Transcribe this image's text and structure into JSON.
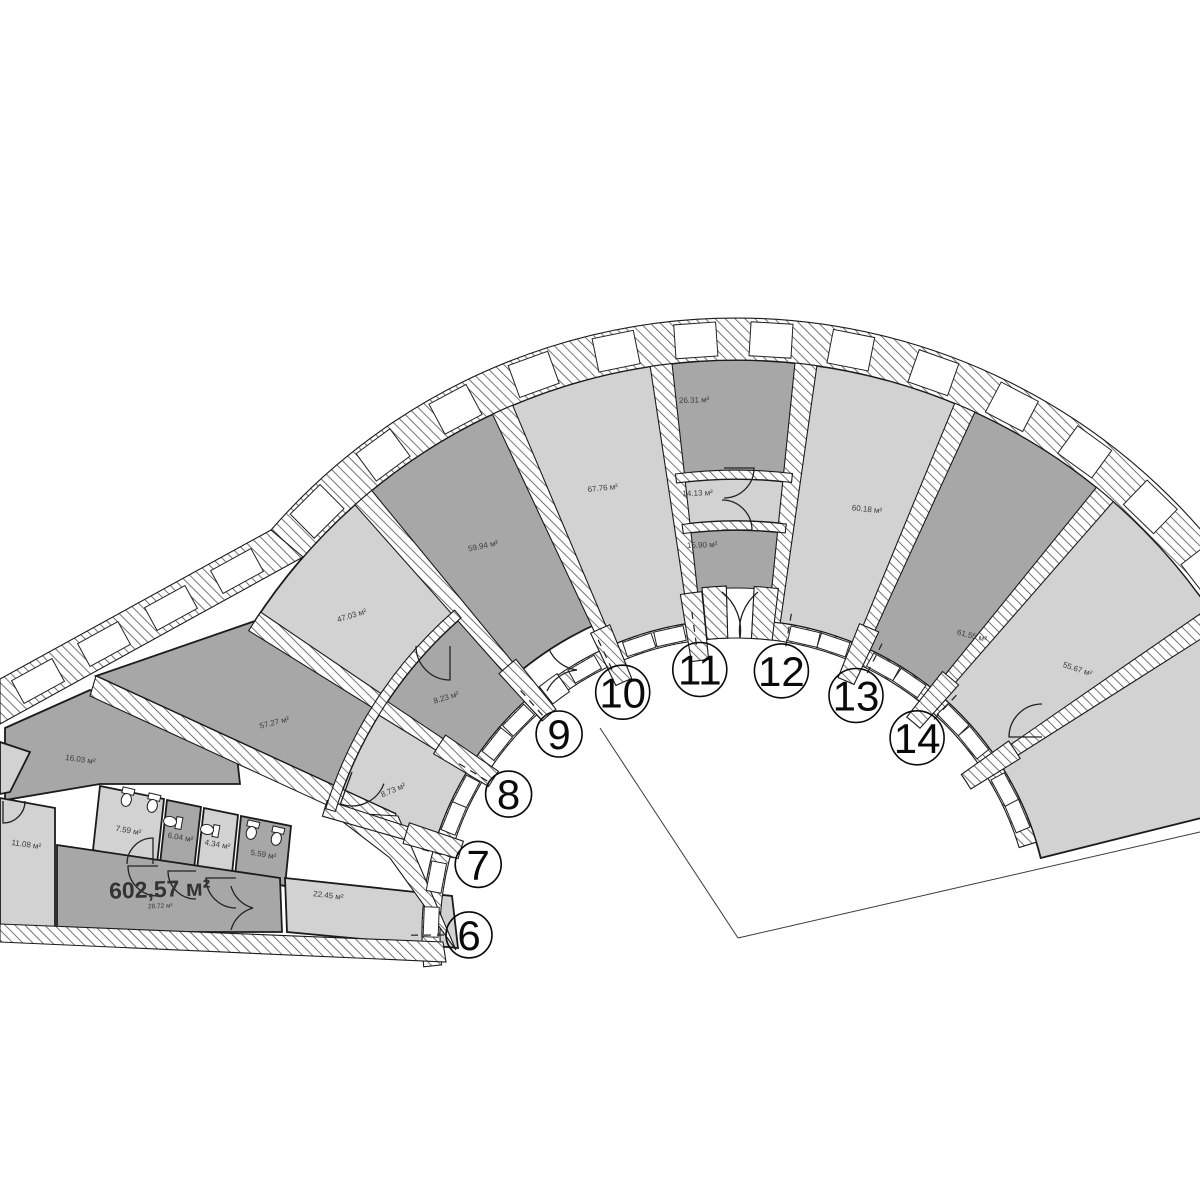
{
  "colors": {
    "background": "#ffffff",
    "room_light": "#d2d2d2",
    "room_dark": "#a7a7a7",
    "wall_line": "#1b1b1b",
    "hatch_line": "#444444",
    "label_text": "#3c3c3c",
    "number_text": "#0a0a0a"
  },
  "plan": {
    "center": [
      736,
      934
    ],
    "units": [
      {
        "number": "6",
        "angle": 180.2,
        "size": "small"
      },
      {
        "number": "7",
        "angle": 164.9,
        "size": "small"
      },
      {
        "number": "8",
        "angle": 148.4,
        "size": "small"
      },
      {
        "number": "9",
        "angle": 131.5,
        "size": "small"
      },
      {
        "number": "10",
        "angle": 115.1,
        "size": "large"
      },
      {
        "number": "11",
        "angle": 97.8,
        "size": "large"
      },
      {
        "number": "12",
        "angle": 80.2,
        "size": "large"
      },
      {
        "number": "13",
        "angle": 63.3,
        "size": "large"
      },
      {
        "number": "14",
        "angle": 47.3,
        "size": "large"
      }
    ],
    "wedge_rooms": [
      {
        "name": "room-edge-sliver",
        "area": "",
        "fill": "light",
        "a1": 14,
        "a2": 33.5,
        "r1": 314,
        "r2": 574,
        "label": null
      },
      {
        "name": "room-55-67",
        "area": "55.67 м²",
        "fill": "light",
        "a1": 33.5,
        "a2": 50,
        "r1": 314,
        "r2": 574,
        "label": {
          "a": 37.6,
          "r": 430,
          "rot": 18
        }
      },
      {
        "name": "room-14",
        "area": "61.55 м²",
        "fill": "dark",
        "a1": 50,
        "a2": 66.5,
        "r1": 314,
        "r2": 574,
        "label": {
          "a": 51.5,
          "r": 378,
          "rot": 14
        }
      },
      {
        "name": "room-13",
        "area": "60.18 м²",
        "fill": "light",
        "a1": 66.5,
        "a2": 83,
        "r1": 314,
        "r2": 574,
        "label": {
          "a": 72.8,
          "r": 442,
          "rot": 6
        }
      },
      {
        "name": "room-12-top",
        "area": "26.31 м²",
        "fill": "dark",
        "a1": 83,
        "a2": 97.5,
        "r1": 460,
        "r2": 574,
        "label": {
          "a": 94.5,
          "r": 533,
          "rot": -2
        }
      },
      {
        "name": "room-12-mid",
        "area": "14.13 м²",
        "fill": "light",
        "a1": 83,
        "a2": 97.5,
        "r1": 413,
        "r2": 455,
        "label": {
          "a": 95.0,
          "r": 440,
          "rot": -2
        }
      },
      {
        "name": "room-11-low",
        "area": "15.90 м²",
        "fill": "dark",
        "a1": 83,
        "a2": 97.5,
        "r1": 330,
        "r2": 404,
        "label": {
          "a": 95.0,
          "r": 388,
          "rot": -2
        }
      },
      {
        "name": "room-10",
        "area": "67.76 м²",
        "fill": "light",
        "a1": 97.5,
        "a2": 114,
        "r1": 314,
        "r2": 574,
        "label": {
          "a": 106.7,
          "r": 463,
          "rot": -6
        }
      },
      {
        "name": "room-9",
        "area": "59.94 м²",
        "fill": "dark",
        "a1": 114,
        "a2": 130.5,
        "r1": 340,
        "r2": 574,
        "label": {
          "a": 123.2,
          "r": 461,
          "rot": -12
        }
      },
      {
        "name": "room-8",
        "area": "47.03 м²",
        "fill": "light",
        "a1": 130.5,
        "a2": 147,
        "r1": 425,
        "r2": 574,
        "label": {
          "a": 140.5,
          "r": 497,
          "rot": -17
        }
      },
      {
        "name": "room-8-23",
        "area": "8.23 м²",
        "fill": "dark",
        "a1": 131,
        "a2": 147.4,
        "r1": 314,
        "r2": 419,
        "label": {
          "a": 141.0,
          "r": 372,
          "rot": -17
        }
      },
      {
        "name": "room-8-73",
        "area": "8.73 м²",
        "fill": "light",
        "a1": 147.4,
        "a2": 163,
        "r1": 314,
        "r2": 419,
        "label": {
          "a": 157.5,
          "r": 370,
          "rot": -23
        }
      }
    ],
    "poly_rooms": [
      {
        "name": "room-7",
        "area": "57.27 м²",
        "fill": "dark",
        "points": [
          [
            380,
            703
          ],
          [
            255,
            621
          ],
          [
            96,
            676
          ],
          [
            396,
            814
          ],
          [
            330,
            812
          ]
        ],
        "label": {
          "x": 275,
          "y": 725,
          "rot": -14
        }
      },
      {
        "name": "room-16-03",
        "area": "16.03 м²",
        "fill": "dark",
        "points": [
          [
            5,
            728
          ],
          [
            90,
            690
          ],
          [
            237,
            757
          ],
          [
            240,
            784
          ],
          [
            100,
            784
          ],
          [
            5,
            800
          ]
        ],
        "label": {
          "x": 80,
          "y": 762,
          "rot": 8
        }
      },
      {
        "name": "room-7-59",
        "area": "7.59 м²",
        "fill": "light",
        "points": [
          [
            100,
            786
          ],
          [
            164,
            799
          ],
          [
            157,
            864
          ],
          [
            93,
            850
          ]
        ],
        "label": {
          "x": 128,
          "y": 833,
          "rot": 10
        }
      },
      {
        "name": "room-6-04",
        "area": "6.04 м²",
        "fill": "dark",
        "points": [
          [
            167,
            800
          ],
          [
            201,
            807
          ],
          [
            194,
            869
          ],
          [
            160,
            864
          ]
        ],
        "label": {
          "x": 180,
          "y": 840,
          "rot": 10
        }
      },
      {
        "name": "room-4-34",
        "area": "4.34 м²",
        "fill": "light",
        "points": [
          [
            204,
            808
          ],
          [
            238,
            815
          ],
          [
            232,
            874
          ],
          [
            197,
            869
          ]
        ],
        "label": {
          "x": 217,
          "y": 847,
          "rot": 10
        }
      },
      {
        "name": "room-5-59",
        "area": "5.59 м²",
        "fill": "dark",
        "points": [
          [
            241,
            816
          ],
          [
            291,
            826
          ],
          [
            285,
            886
          ],
          [
            235,
            876
          ]
        ],
        "label": {
          "x": 263,
          "y": 857,
          "rot": 10
        }
      },
      {
        "name": "room-11-08",
        "area": "11.08 м²",
        "fill": "light",
        "points": [
          [
            0,
            798
          ],
          [
            55,
            808
          ],
          [
            55,
            932
          ],
          [
            0,
            932
          ]
        ],
        "label": {
          "x": 26,
          "y": 847,
          "rot": 8
        }
      },
      {
        "name": "room-602",
        "area": "",
        "fill": "dark",
        "points": [
          [
            57,
            845
          ],
          [
            280,
            878
          ],
          [
            282,
            932
          ],
          [
            57,
            932
          ]
        ],
        "label": null
      },
      {
        "name": "room-22-45",
        "area": "22.45 м²",
        "fill": "light",
        "points": [
          [
            285,
            878
          ],
          [
            452,
            896
          ],
          [
            458,
            948
          ],
          [
            287,
            932
          ]
        ],
        "label": {
          "x": 328,
          "y": 898,
          "rot": 7
        }
      },
      {
        "name": "room-left-sliver",
        "area": "",
        "fill": "light",
        "points": [
          [
            0,
            742
          ],
          [
            30,
            752
          ],
          [
            10,
            792
          ],
          [
            0,
            794
          ]
        ],
        "label": null
      }
    ],
    "main_area_label": {
      "text": "602,57 м²",
      "sub": "28.72 м²",
      "x": 160,
      "y": 897,
      "rot": -2
    },
    "walls": {
      "outer_arc": {
        "a1": 14,
        "a2": 139,
        "r1": 574,
        "r2": 616
      },
      "inner_arc": {
        "a1": 17,
        "a2": 186,
        "r1": 296,
        "r2": 314
      },
      "outer_straight": [
        [
          271,
          530
        ],
        [
          0,
          679
        ],
        [
          0,
          724
        ],
        [
          303,
          557
        ]
      ],
      "band_diag": [
        [
          96,
          676
        ],
        [
          396,
          814
        ],
        [
          390,
          834
        ],
        [
          90,
          696
        ]
      ],
      "filler_right": [
        [
          330,
          812
        ],
        [
          398,
          816
        ],
        [
          456,
          950
        ],
        [
          390,
          858
        ]
      ],
      "bottom_band": [
        [
          0,
          924
        ],
        [
          443,
          942
        ],
        [
          446,
          962
        ],
        [
          0,
          942
        ]
      ],
      "radial": [
        {
          "a": 33.5,
          "r1": 314,
          "r2": 574
        },
        {
          "a": 50,
          "r1": 314,
          "r2": 574
        },
        {
          "a": 66.5,
          "r1": 314,
          "r2": 574
        },
        {
          "a": 83,
          "r1": 314,
          "r2": 574
        },
        {
          "a": 97.5,
          "r1": 314,
          "r2": 574
        },
        {
          "a": 114,
          "r1": 314,
          "r2": 574
        },
        {
          "a": 130.5,
          "r1": 314,
          "r2": 574
        },
        {
          "a": 147,
          "r1": 425,
          "r2": 574
        },
        {
          "a": 147.4,
          "r1": 300,
          "r2": 425
        },
        {
          "a": 163,
          "r1": 296,
          "r2": 430
        }
      ],
      "stubs": [
        {
          "a": 33.5,
          "r1": 276,
          "r2": 334
        },
        {
          "a": 50,
          "r1": 276,
          "r2": 334
        },
        {
          "a": 66.5,
          "r1": 276,
          "r2": 334
        },
        {
          "a": 97.5,
          "r1": 276,
          "r2": 344
        },
        {
          "a": 114,
          "r1": 276,
          "r2": 334
        },
        {
          "a": 130.5,
          "r1": 288,
          "r2": 352
        },
        {
          "a": 147.4,
          "r1": 288,
          "r2": 352
        },
        {
          "a": 163,
          "r1": 288,
          "r2": 345
        }
      ],
      "column_arcs": [
        {
          "a1": 83,
          "a2": 97.5,
          "r1": 455,
          "r2": 464
        },
        {
          "a1": 83,
          "a2": 97.5,
          "r1": 404,
          "r2": 413
        }
      ],
      "small_room_arc": {
        "a1": 131,
        "a2": 163,
        "r1": 419,
        "r2": 429
      },
      "entrance_piers": [
        {
          "a1": 83,
          "a2": 87,
          "r1": 296,
          "r2": 348
        },
        {
          "a1": 91.6,
          "a2": 95.6,
          "r1": 296,
          "r2": 348
        }
      ]
    },
    "openings": {
      "outer_window_segments": [
        {
          "a1": 14,
          "a2": 33.5,
          "n": 3
        },
        {
          "a1": 33.5,
          "a2": 50,
          "n": 2
        },
        {
          "a1": 50,
          "a2": 66.5,
          "n": 2
        },
        {
          "a1": 66.5,
          "a2": 83,
          "n": 2
        },
        {
          "a1": 83,
          "a2": 97.5,
          "n": 2
        },
        {
          "a1": 97.5,
          "a2": 114,
          "n": 2
        },
        {
          "a1": 114,
          "a2": 130.5,
          "n": 2
        },
        {
          "a1": 130.5,
          "a2": 139,
          "n": 1
        }
      ],
      "inner_window_segments": [
        {
          "a1": 20,
          "a2": 31,
          "n": 2
        },
        {
          "a1": 36,
          "a2": 47.5,
          "n": 2
        },
        {
          "a1": 52.5,
          "a2": 64,
          "n": 2
        },
        {
          "a1": 68.5,
          "a2": 80,
          "n": 2
        },
        {
          "a1": 99.5,
          "a2": 111.5,
          "n": 2
        },
        {
          "a1": 116.5,
          "a2": 123,
          "n": 1
        },
        {
          "a1": 132.5,
          "a2": 144.5,
          "n": 2
        },
        {
          "a1": 149.5,
          "a2": 160.5,
          "n": 2
        },
        {
          "a1": 165,
          "a2": 182,
          "n": 2
        }
      ],
      "straight_windows": [
        {
          "x": 237,
          "y": 571
        },
        {
          "x": 171,
          "y": 608
        },
        {
          "x": 104,
          "y": 644
        },
        {
          "x": 38,
          "y": 681
        }
      ],
      "straight_window_rot": 151.3,
      "vestibule_gap": {
        "a1": 87,
        "a2": 91.6,
        "r1": 296,
        "r2": 346
      },
      "b_gap": {
        "a1": 124.5,
        "a2": 128.5,
        "r1": 294,
        "r2": 316
      }
    },
    "doors": [
      {
        "name": "door-8-23",
        "h": [
          450,
          646
        ],
        "r": 34,
        "s1": 90,
        "s2": 180,
        "sweep": 1
      },
      {
        "name": "door-8-73",
        "h": [
          352,
          772
        ],
        "r": 34,
        "s1": 110,
        "s2": 20,
        "sweep": 0
      },
      {
        "name": "door-26-14",
        "h": [
          724,
          468
        ],
        "r": 30,
        "s1": 0,
        "s2": 90,
        "sweep": 1
      },
      {
        "name": "door-14-15",
        "h": [
          722,
          530
        ],
        "r": 30,
        "s1": 0,
        "s2": 270,
        "sweep": 0
      },
      {
        "name": "door-55-67",
        "h": [
          1042,
          737
        ],
        "r": 33,
        "s1": 180,
        "s2": 270,
        "sweep": 1
      },
      {
        "name": "door-wc-1",
        "h": [
          158,
          866
        ],
        "r": 30,
        "s1": 180,
        "s2": 90,
        "sweep": 0
      },
      {
        "name": "door-wc-2",
        "h": [
          196,
          871
        ],
        "r": 28,
        "s1": 180,
        "s2": 90,
        "sweep": 0
      },
      {
        "name": "door-wc-3",
        "h": [
          236,
          878
        ],
        "r": 30,
        "s1": 180,
        "s2": 90,
        "sweep": 0
      },
      {
        "name": "door-7-59",
        "h": [
          153,
          864
        ],
        "r": 26,
        "s1": 270,
        "s2": 180,
        "sweep": 0
      },
      {
        "name": "door-11-08",
        "h": [
          3,
          801
        ],
        "r": 22,
        "s1": 90,
        "s2": 0,
        "sweep": 0
      }
    ],
    "double_doors": [
      {
        "name": "entrance-door-left",
        "p1": [
          722,
          592
        ],
        "p2": [
          740,
          638
        ],
        "sweep": 1
      },
      {
        "name": "entrance-door-right",
        "p1": [
          758,
          592
        ],
        "p2": [
          740,
          638
        ],
        "sweep": 0
      },
      {
        "name": "door-b-top",
        "p1": [
          549,
          649
        ],
        "p2": [
          577,
          670
        ],
        "sweep": 0
      },
      {
        "name": "door-b-bottom",
        "p1": [
          547,
          691
        ],
        "p2": [
          577,
          670
        ],
        "sweep": 1
      },
      {
        "name": "door-602-top",
        "p1": [
          231,
          886
        ],
        "p2": [
          253,
          908
        ],
        "sweep": 0
      },
      {
        "name": "door-602-bottom",
        "p1": [
          231,
          930
        ],
        "p2": [
          253,
          908
        ],
        "sweep": 1
      }
    ],
    "toilets": [
      {
        "x": 127,
        "y": 797,
        "rot": 13
      },
      {
        "x": 153,
        "y": 803,
        "rot": 13
      },
      {
        "x": 173,
        "y": 822,
        "rot": 100
      },
      {
        "x": 210,
        "y": 830,
        "rot": 100
      },
      {
        "x": 252,
        "y": 830,
        "rot": 13
      },
      {
        "x": 277,
        "y": 836,
        "rot": 13
      }
    ],
    "leader_r1": 292,
    "leader_r2": 330,
    "number_r": 267,
    "construction_lines": [
      [
        600,
        728,
        738,
        938
      ],
      [
        738,
        938,
        1200,
        832
      ]
    ]
  }
}
